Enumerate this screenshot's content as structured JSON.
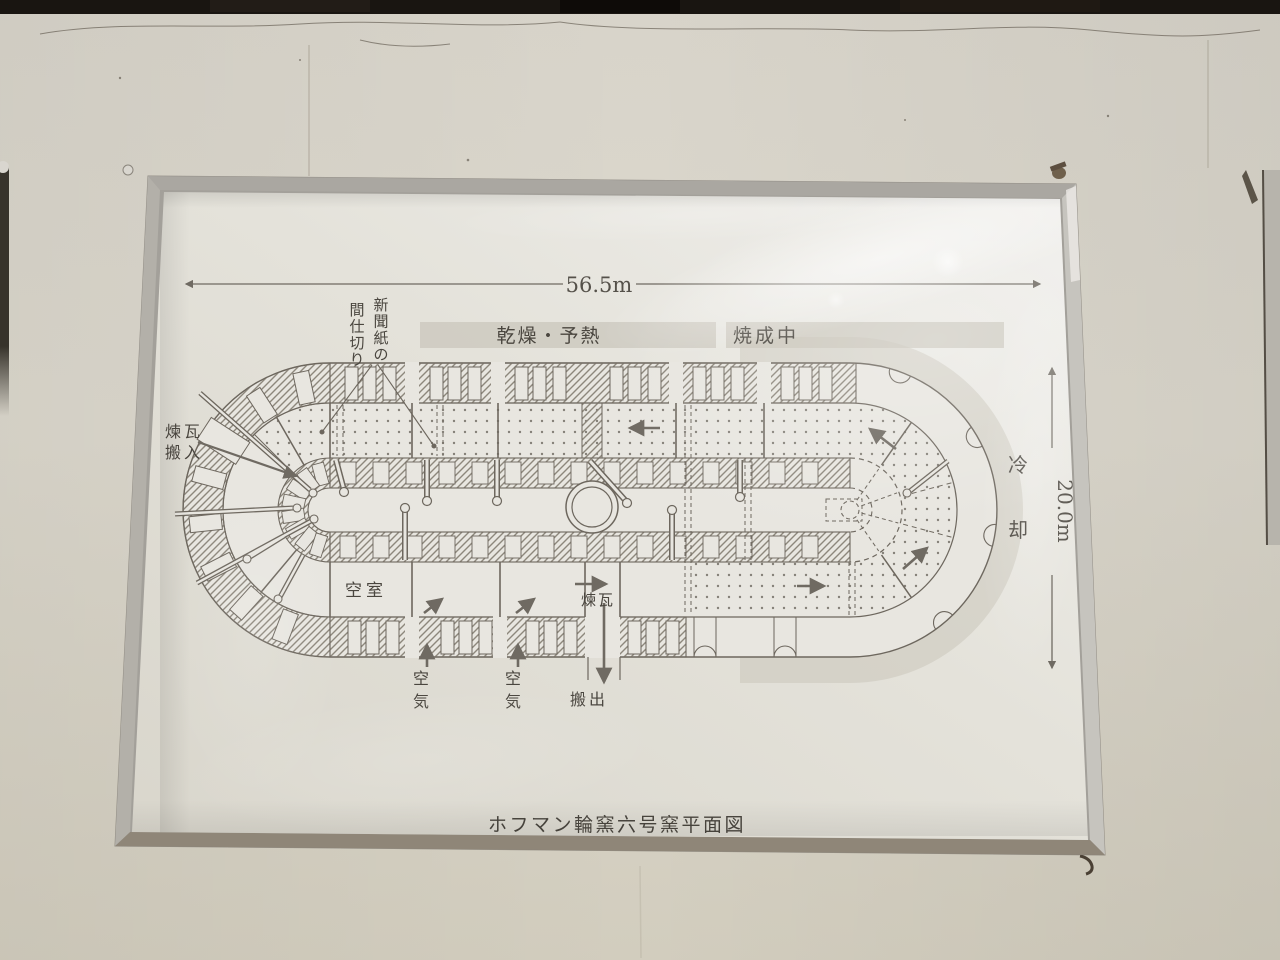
{
  "diagram": {
    "title": "ホフマン輪窯六号窯平面図",
    "dim_width": "56.5m",
    "dim_height": "20.0m",
    "zone_drying": "乾燥・予熱",
    "zone_firing": "焼成中",
    "zone_cooling": "冷却",
    "label_newspaper_right": "新聞紙の",
    "label_newspaper_left": "間仕切り",
    "label_load1": "煉瓦",
    "label_load2": "搬入",
    "label_empty": "空室",
    "label_air1": "空気",
    "label_air2": "空気",
    "label_brick": "煉瓦",
    "label_unload": "搬出"
  }
}
